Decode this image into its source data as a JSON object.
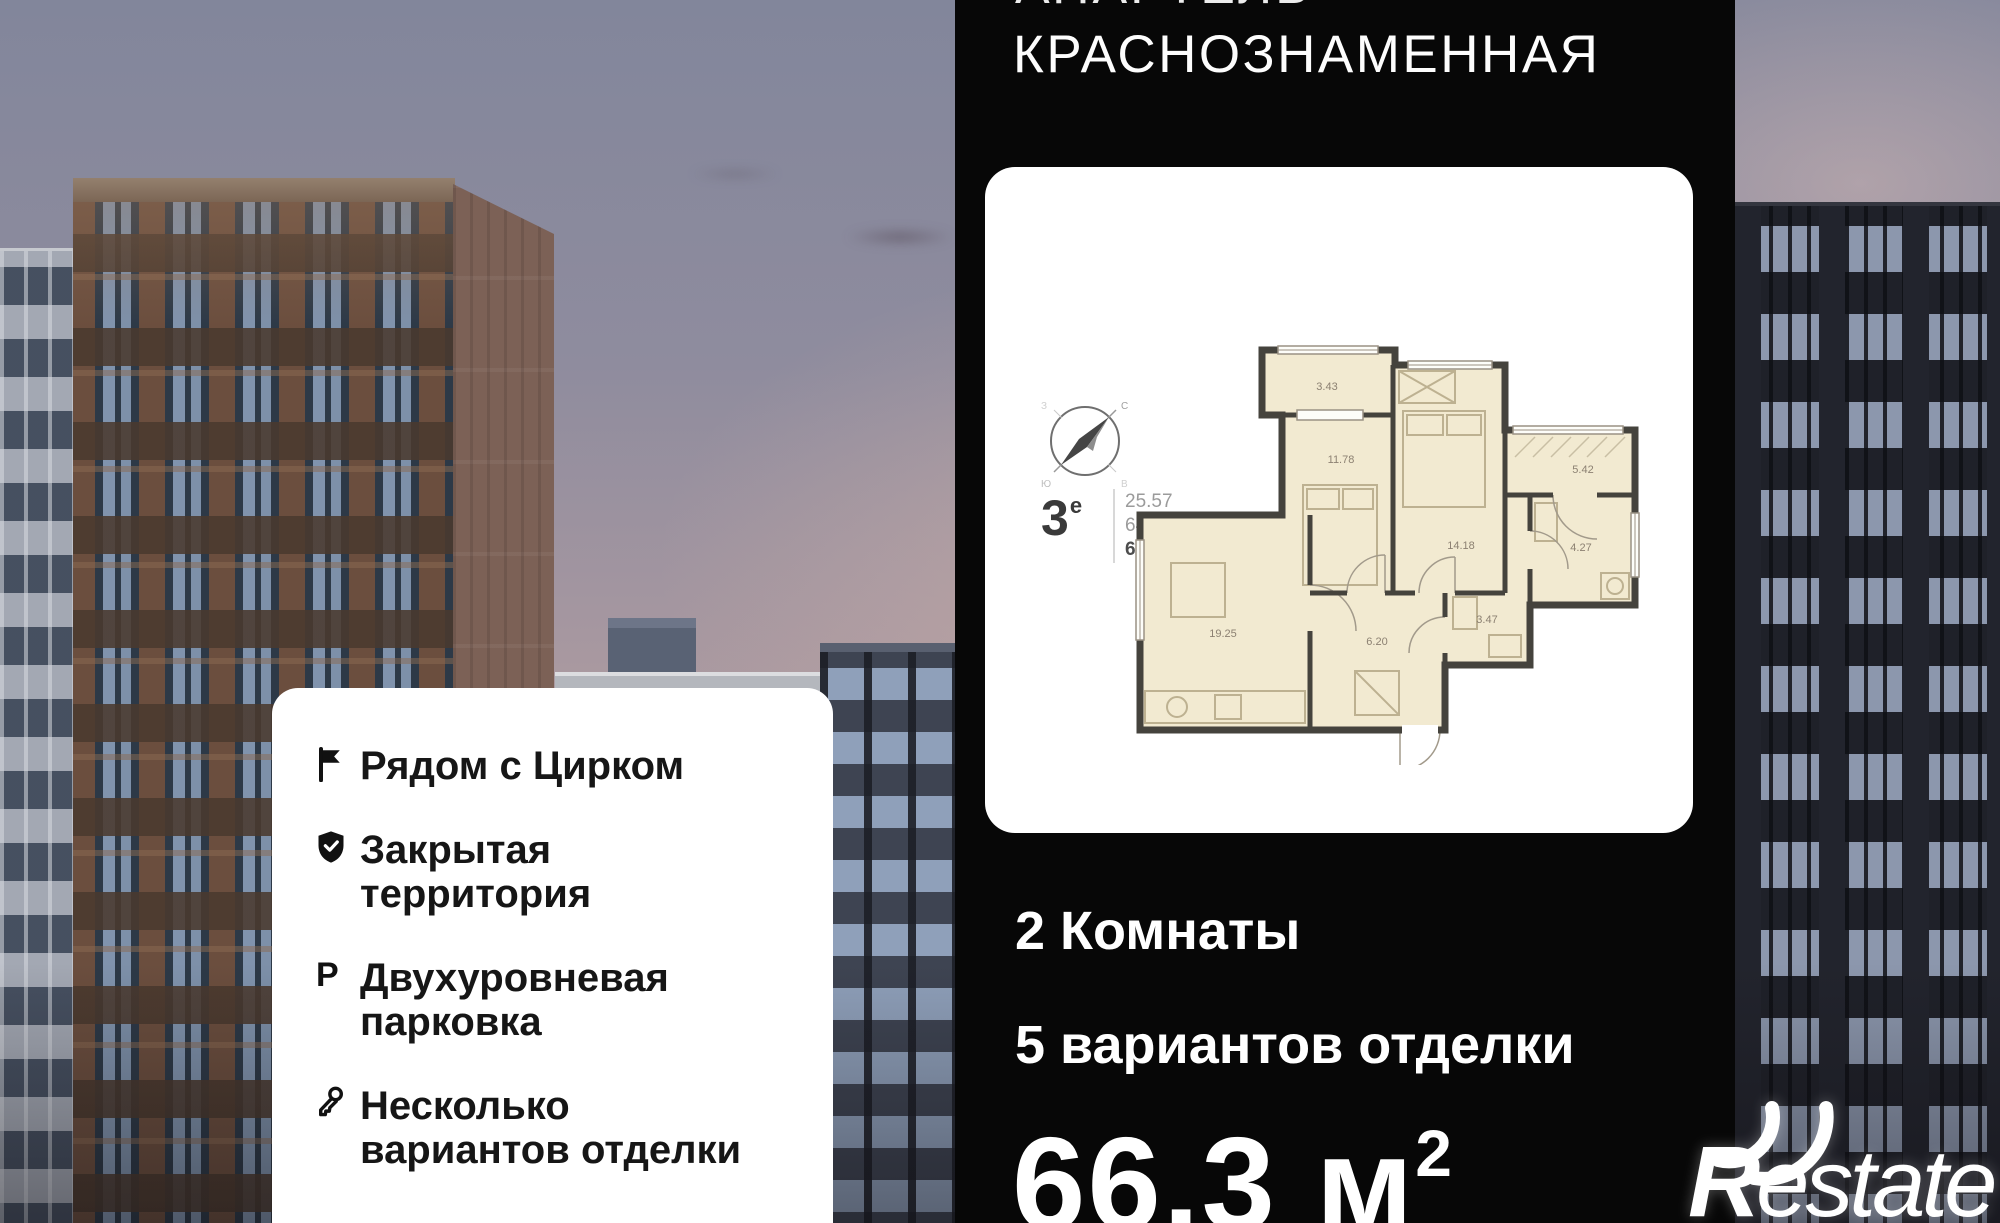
{
  "colors": {
    "panel_bg": "#070707",
    "card_bg": "#ffffff",
    "plan_floor": "#f2ead1",
    "plan_wall": "#45433d",
    "sky_top": "#82869b",
    "sky_horizon": "#c9aca6"
  },
  "panel": {
    "cropped_top_line": "АПАРТЕЛЬ",
    "title": "КРАСНОЗНАМЕННАЯ",
    "rooms_count_line": "2 Комнаты",
    "finish_options_line": "5 вариантов отделки",
    "area": {
      "value": "66.3",
      "unit": "м",
      "superscript": "2"
    }
  },
  "plan_card": {
    "flat_type": {
      "number": "3",
      "suffix": "е"
    },
    "stats": [
      "25.57",
      "64.58",
      "66.30"
    ],
    "compass_points": {
      "n": "С",
      "e": "В",
      "s": "Ю",
      "w": "З"
    },
    "room_areas": [
      "3.43",
      "11.78",
      "14.18",
      "5.42",
      "19.25",
      "6.20",
      "3.47",
      "4.27"
    ]
  },
  "features_card": {
    "items": [
      {
        "icon": "flag-icon",
        "lines": [
          "Рядом с Цирком",
          ""
        ]
      },
      {
        "icon": "shield-check-icon",
        "lines": [
          "Закрытая",
          "территория"
        ]
      },
      {
        "icon": "parking-icon",
        "lines": [
          "Двухуровневая",
          "парковка"
        ]
      },
      {
        "icon": "key-icon",
        "lines": [
          "Несколько",
          "вариантов отделки"
        ]
      }
    ]
  },
  "logo": {
    "initial": "R",
    "rest": "estate"
  }
}
